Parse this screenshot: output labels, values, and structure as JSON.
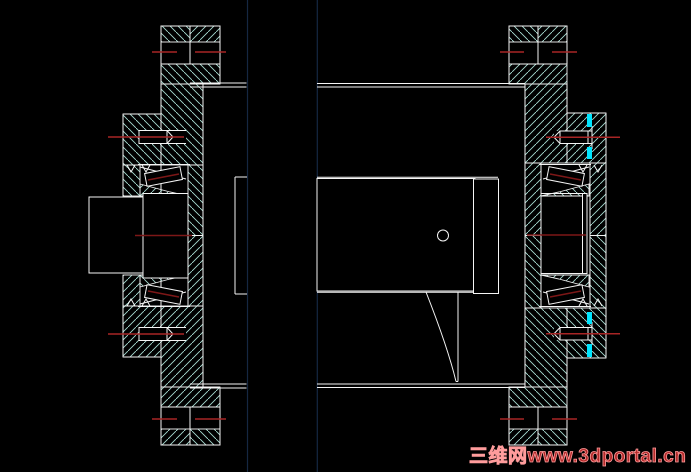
{
  "window": {
    "description": "CAD section drawing of a flanged wheel-hub assembly with tapered roller bearings",
    "background": "#000000"
  },
  "watermark": {
    "text": "三维网www.3dportal.cn",
    "fill_color": "#b32a2a",
    "outline_color": "#ff9c9c"
  },
  "colors": {
    "bg": "#000000",
    "hatch": "#a8dcd2",
    "line": "#f5f5f5",
    "center_red": "#a82525",
    "dark_red": "#7d1717",
    "navy": "#152742",
    "cyan": "#00e5ff",
    "wm_fill": "#b32a2a",
    "wm_stroke": "#ff9c9c"
  },
  "views": {
    "left": "left flange hub section with two studs, two tapered roller bearings and shaft stub",
    "right": "right flange hub section with drum shell, center hub block, collar and web"
  }
}
